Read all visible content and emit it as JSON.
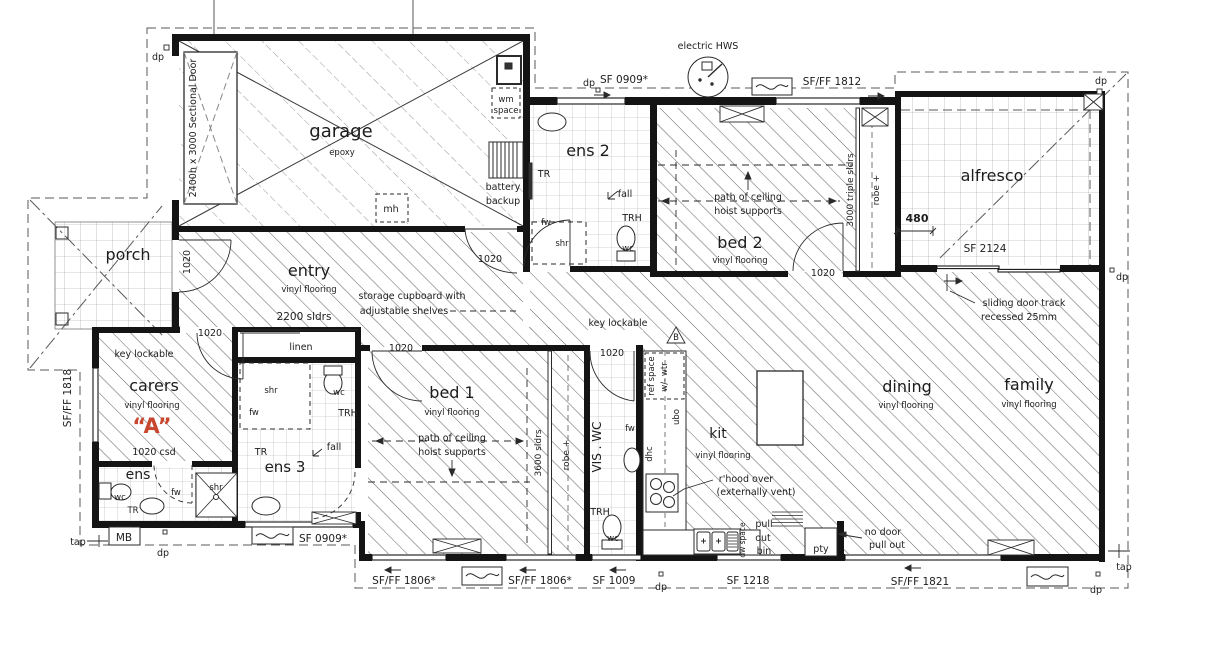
{
  "floorplan": {
    "rooms": {
      "garage": {
        "name": "garage",
        "finish": "epoxy"
      },
      "porch": {
        "name": "porch"
      },
      "entry": {
        "name": "entry",
        "finish": "vinyl flooring"
      },
      "ens2": {
        "name": "ens 2"
      },
      "bed2": {
        "name": "bed 2",
        "finish": "vinyl flooring"
      },
      "alfresco": {
        "name": "alfresco"
      },
      "carers": {
        "name": "carers",
        "finish": "vinyl flooring",
        "unit_mark": "“A”",
        "unit_mark_color": "#c8472e"
      },
      "ens": {
        "name": "ens"
      },
      "ens3": {
        "name": "ens 3"
      },
      "bed1": {
        "name": "bed 1",
        "finish": "vinyl flooring"
      },
      "vis_wc": {
        "name": "VIS . WC"
      },
      "kit": {
        "name": "kit",
        "finish": "vinyl flooring"
      },
      "dining": {
        "name": "dining",
        "finish": "vinyl flooring"
      },
      "family": {
        "name": "family",
        "finish": "vinyl flooring"
      },
      "linen": {
        "name": "linen"
      },
      "pty": {
        "name": "pty"
      }
    },
    "windows": {
      "sectional_door": "2400h x 3000 Sectional Door",
      "sf0909": "SF 0909*",
      "sfff1812": "SF/FF 1812",
      "sf2124": "SF 2124",
      "sfff1818": "SF/FF 1818",
      "sfff1806": "SF/FF 1806*",
      "sf1009": "SF 1009",
      "sf1218": "SF 1218",
      "sfff1821": "SF/FF 1821"
    },
    "doors": {
      "leaf": "1020",
      "carers_cavity": "1020 csd",
      "robe_bed2": "3000 triple sldrs",
      "robe_bed1": "3600 sldrs",
      "entry_cupboard": "2200 sldrs"
    },
    "fixtures": {
      "wc": "wc",
      "shr": "shr",
      "fw": "fw",
      "tr": "TR",
      "trh": "TRH",
      "fall": "fall"
    },
    "notes": {
      "storage1": "storage cupboard with",
      "storage2": "adjustable shelves",
      "hoist1": "path of ceiling",
      "hoist2": "hoist supports",
      "key_lockable": "key lockable",
      "slide1": "sliding door track",
      "slide2": "recessed 25mm",
      "rhood1": "r'hood over",
      "rhood2": "(externally vent)",
      "nodoor1": "no door",
      "nodoor2": "pull out",
      "pull1": "pull",
      "pull2": "out",
      "pull3": "bin",
      "battery1": "battery",
      "battery2": "backup",
      "wm1": "wm",
      "wm2": "space",
      "ref1": "ref space",
      "ref2": "w/- wtr",
      "ubo": "ubo",
      "dhc": "dhc",
      "dw": "dw space",
      "section_marker": "B"
    },
    "site": {
      "dp": "dp",
      "tap": "tap",
      "mb": "MB",
      "hws": "electric HWS"
    },
    "dims": {
      "alfresco_480": "480"
    }
  }
}
